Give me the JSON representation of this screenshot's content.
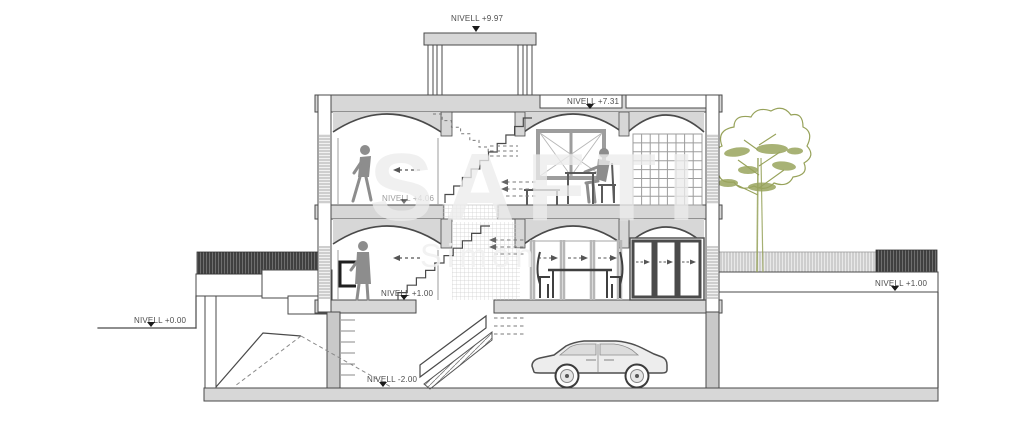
{
  "levels": [
    {
      "name": "roof-terrace",
      "text": "NIVELL +9.97"
    },
    {
      "name": "roof",
      "text": "NIVELL +7.31"
    },
    {
      "name": "first-floor",
      "text": "NIVELL +4.06"
    },
    {
      "name": "ground-floor",
      "text": "NIVELL +1.00"
    },
    {
      "name": "garden-right",
      "text": "NIVELL +1.00"
    },
    {
      "name": "street",
      "text": "NIVELL +0.00"
    },
    {
      "name": "basement",
      "text": "NIVELL -2.00"
    }
  ],
  "watermark": {
    "brand": "SAFTI",
    "agent": "Simon"
  },
  "palette": {
    "line": "#4a4a4a",
    "slab_fill": "#d7d7d7",
    "dark_hatch": "#2b2b2b",
    "light_hatch": "#b4b4b4",
    "tree": "#97a25a",
    "watermark": "#ececec"
  }
}
